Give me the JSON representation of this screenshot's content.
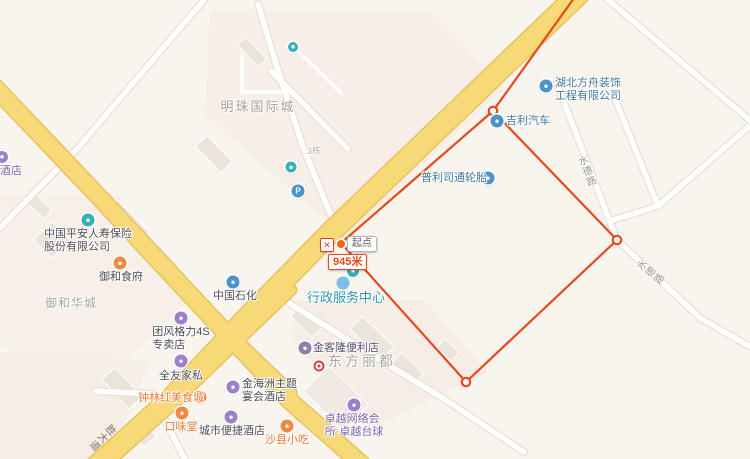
{
  "map": {
    "measurement": {
      "start_label": "起点",
      "distance": "945米",
      "close_glyph": "✕",
      "color": "#e8481a",
      "points": [
        [
          341,
          243
        ],
        [
          493,
          111
        ],
        [
          617,
          240
        ],
        [
          466,
          382
        ]
      ]
    },
    "labels": [
      {
        "name": "road-label-shengdadao",
        "lines": [
          "胜大道"
        ],
        "x": 101,
        "y": 436,
        "cls": "road",
        "vertical": true,
        "rot": 46
      },
      {
        "name": "road-label-shuidelu-north",
        "lines": [
          "水德路"
        ],
        "x": 585,
        "y": 172,
        "cls": "road-w",
        "vertical": true,
        "rot": -21
      },
      {
        "name": "road-label-shuidelu-south",
        "lines": [
          "水德路"
        ],
        "x": 649,
        "y": 274,
        "cls": "road-w",
        "vertical": true,
        "rot": -51
      },
      {
        "name": "area-label-mingzhu",
        "lines": [
          "明珠国际城"
        ],
        "x": 258,
        "y": 101,
        "cls": "area",
        "align": "center"
      },
      {
        "name": "area-label-yuhehuacheng",
        "lines": [
          "御和华城"
        ],
        "x": 71,
        "y": 297,
        "cls": "area-sm",
        "align": "center"
      },
      {
        "name": "area-label-dongfanglidu",
        "lines": [
          "东方丽都"
        ],
        "x": 362,
        "y": 355,
        "cls": "area-lg",
        "align": "center"
      },
      {
        "name": "label-building-3",
        "lines": [
          "3栋"
        ],
        "x": 314,
        "y": 145,
        "cls": "tiny",
        "align": "center"
      },
      {
        "name": "poi-hotel-left-edge",
        "lines": [
          "酒店"
        ],
        "x": 0,
        "y": 165,
        "cls": "purple",
        "align": "left",
        "icon": {
          "x": 2,
          "y": 157,
          "cls": "purple",
          "size": 12
        }
      },
      {
        "name": "poi-hubei-fangzhou-decoration",
        "lines": [
          "湖北方舟装饰",
          "工程有限公司"
        ],
        "x": 555,
        "y": 77,
        "cls": "blue",
        "align": "left",
        "icon": {
          "x": 546,
          "y": 86,
          "cls": "blue"
        }
      },
      {
        "name": "poi-geely-auto",
        "lines": [
          "吉利汽车"
        ],
        "x": 506,
        "y": 115,
        "cls": "blue",
        "align": "left",
        "icon": {
          "x": 497,
          "y": 121,
          "cls": "blue"
        }
      },
      {
        "name": "poi-bridgestone-tires",
        "lines": [
          "普利司通轮胎"
        ],
        "x": 421,
        "y": 172,
        "cls": "blue",
        "align": "left",
        "icon": {
          "x": 488,
          "y": 178,
          "cls": "blue"
        }
      },
      {
        "name": "poi-pingan-insurance",
        "lines": [
          "中国平安人寿保险",
          "股份有限公司"
        ],
        "x": 88,
        "y": 228,
        "cls": "dark",
        "align": "center",
        "icon": {
          "x": 88,
          "y": 220,
          "cls": "teal"
        }
      },
      {
        "name": "poi-yuhe-restaurant",
        "lines": [
          "御和食府"
        ],
        "x": 121,
        "y": 271,
        "cls": "dark",
        "align": "center",
        "icon": {
          "x": 120,
          "y": 263,
          "cls": "orange"
        }
      },
      {
        "name": "poi-sinopec",
        "lines": [
          "中国石化"
        ],
        "x": 235,
        "y": 290,
        "cls": "dark",
        "align": "center",
        "icon": {
          "x": 233,
          "y": 282,
          "cls": "blue"
        }
      },
      {
        "name": "poi-admin-service-center",
        "lines": [
          "行政服务中心"
        ],
        "x": 346,
        "y": 291,
        "cls": "teal-lg",
        "align": "center",
        "icon": {
          "x": 353,
          "y": 271,
          "cls": "teal",
          "size": 12
        }
      },
      {
        "name": "pond",
        "cls": "pond",
        "icon": {
          "x": 343,
          "y": 283,
          "cls": "pond",
          "size": 13,
          "glyph": ""
        }
      },
      {
        "name": "poi-gree-4s-store",
        "lines": [
          "团风格力4S",
          "专卖店"
        ],
        "x": 181,
        "y": 326,
        "cls": "dark",
        "align": "center",
        "icon": {
          "x": 181,
          "y": 318,
          "cls": "purple"
        }
      },
      {
        "name": "poi-quanyou-furniture",
        "lines": [
          "全友家私"
        ],
        "x": 181,
        "y": 370,
        "cls": "dark",
        "align": "center",
        "icon": {
          "x": 181,
          "y": 361,
          "cls": "purple"
        }
      },
      {
        "name": "poi-jinkelong-store",
        "lines": [
          "金客隆便利店"
        ],
        "x": 313,
        "y": 342,
        "cls": "darkpurple",
        "align": "left",
        "icon": {
          "x": 305,
          "y": 348,
          "cls": "grape"
        }
      },
      {
        "name": "red-poi",
        "icon": {
          "x": 319,
          "y": 366,
          "cls": "red-ring",
          "glyph": ""
        }
      },
      {
        "name": "poi-zhonglinhong-food-city",
        "lines": [
          "钟林红美食城"
        ],
        "x": 138,
        "y": 392,
        "cls": "orange",
        "align": "left",
        "icon": {
          "x": 200,
          "y": 397,
          "cls": "orange"
        }
      },
      {
        "name": "poi-jinhaizhou-hotel",
        "lines": [
          "金海洲主题",
          "宴会酒店"
        ],
        "x": 242,
        "y": 378,
        "cls": "dark",
        "align": "left",
        "icon": {
          "x": 233,
          "y": 387,
          "cls": "purple"
        }
      },
      {
        "name": "poi-kouweitang",
        "lines": [
          "口味堂"
        ],
        "x": 181,
        "y": 421,
        "cls": "orange",
        "align": "center",
        "icon": {
          "x": 182,
          "y": 413,
          "cls": "orange"
        }
      },
      {
        "name": "poi-city-comfort-inn",
        "lines": [
          "城市便捷酒店"
        ],
        "x": 232,
        "y": 425,
        "cls": "dark",
        "align": "center",
        "icon": {
          "x": 231,
          "y": 417,
          "cls": "purple"
        }
      },
      {
        "name": "poi-shaxian-snacks",
        "lines": [
          "沙县小吃"
        ],
        "x": 287,
        "y": 434,
        "cls": "orange",
        "align": "center",
        "icon": {
          "x": 287,
          "y": 426,
          "cls": "orange"
        }
      },
      {
        "name": "poi-zhuoyue-internet-billiards",
        "lines": [
          "卓越网络会",
          "所·卓越台球"
        ],
        "x": 354,
        "y": 413,
        "cls": "purple",
        "align": "center",
        "icon": {
          "x": 354,
          "y": 405,
          "cls": "purple"
        }
      },
      {
        "name": "parking",
        "icon": {
          "x": 298,
          "y": 191,
          "cls": "blue",
          "glyph": "P",
          "size": 13
        }
      },
      {
        "name": "poi-small-upper",
        "icon": {
          "x": 291,
          "y": 167,
          "cls": "teal",
          "size": 11
        }
      },
      {
        "name": "transit-stop",
        "icon": {
          "x": 293,
          "y": 47,
          "cls": "teal",
          "size": 10
        }
      }
    ],
    "colors": {
      "background": "#f8f4ee",
      "major_road": "#f8d978",
      "major_road_casing": "#e9c25f",
      "minor_road": "#ffffff",
      "measure_line": "#e8481a",
      "poi_blue": "#4b93c8",
      "poi_teal": "#36b0b4",
      "poi_orange": "#f08a40",
      "poi_purple": "#9d80cb",
      "area_text": "#a8a49e"
    }
  }
}
